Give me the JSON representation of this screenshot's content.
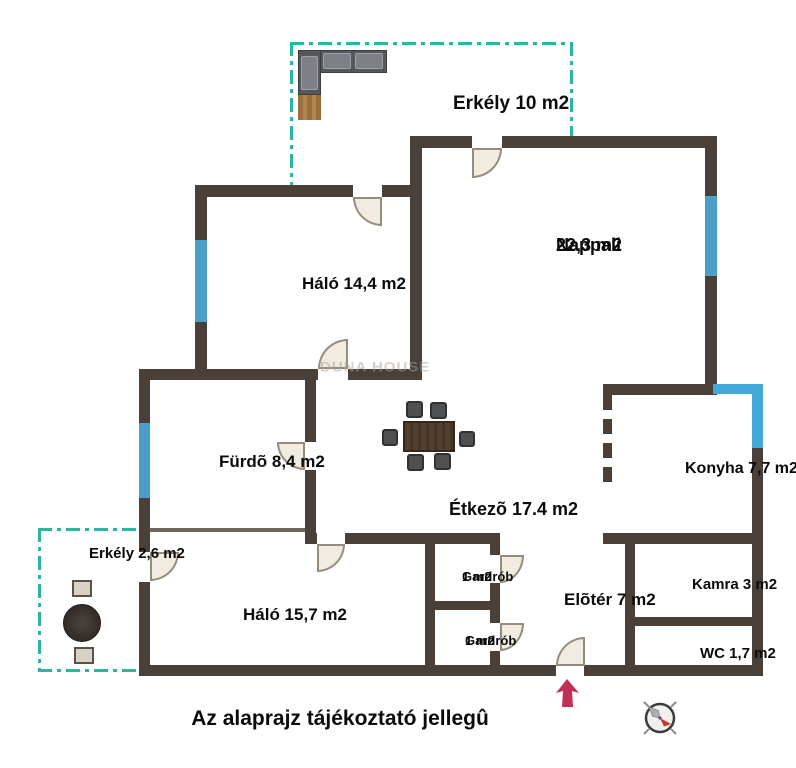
{
  "note": "Az alaprajz tájékoztató jellegû",
  "watermark": "DUNA HOUSE",
  "colors": {
    "wall": "#4a4038",
    "window_blue": "#4c9dc9",
    "corner_window_blue": "#42a8d8",
    "balcony_teal": "#2cb5a0",
    "door_fill": "#f2ebe0",
    "entrance_arrow": "#c23058",
    "compass_red": "#c0392b"
  },
  "rooms": [
    {
      "id": "erkely10",
      "lines": [
        "Erkély 10 m2"
      ],
      "cx": 453,
      "cy": 93,
      "fs": 19
    },
    {
      "id": "nappali",
      "lines": [
        "Nappali",
        "22,3 m2"
      ],
      "cx": 556,
      "cy": 235,
      "fs": 18
    },
    {
      "id": "halo14",
      "lines": [
        "Háló 14,4 m2"
      ],
      "cx": 302,
      "cy": 274,
      "fs": 17
    },
    {
      "id": "furdo",
      "lines": [
        "Fürdõ 8,4 m2"
      ],
      "cx": 219,
      "cy": 452,
      "fs": 17
    },
    {
      "id": "etkezo",
      "lines": [
        "Étkezõ 17.4 m2"
      ],
      "cx": 449,
      "cy": 499,
      "fs": 18
    },
    {
      "id": "konyha",
      "lines": [
        "Konyha 7,7 m2"
      ],
      "cx": 685,
      "cy": 460,
      "fs": 16
    },
    {
      "id": "erkely2",
      "lines": [
        "Erkély 2,6 m2"
      ],
      "cx": 89,
      "cy": 546,
      "fs": 15
    },
    {
      "id": "halo15",
      "lines": [
        "Háló 15,7 m2"
      ],
      "cx": 243,
      "cy": 605,
      "fs": 17
    },
    {
      "id": "gardrob-felso",
      "lines": [
        "Gardrób",
        "1 m2"
      ],
      "cx": 462,
      "cy": 570,
      "fs": 13
    },
    {
      "id": "eloter",
      "lines": [
        "Elõtér 7 m2"
      ],
      "cx": 564,
      "cy": 590,
      "fs": 17
    },
    {
      "id": "gardrob-also",
      "lines": [
        "Gardrób",
        "1 m2"
      ],
      "cx": 465,
      "cy": 634,
      "fs": 13
    },
    {
      "id": "kamra",
      "lines": [
        "Kamra 3 m2"
      ],
      "cx": 692,
      "cy": 577,
      "fs": 15
    },
    {
      "id": "wc",
      "lines": [
        "WC 1,7 m2"
      ],
      "cx": 700,
      "cy": 646,
      "fs": 15
    }
  ],
  "plan": {
    "walls": [
      {
        "x": 410,
        "y": 136,
        "w": 62,
        "h": 12
      },
      {
        "x": 502,
        "y": 136,
        "w": 215,
        "h": 12
      },
      {
        "x": 705,
        "y": 148,
        "w": 12,
        "h": 48
      },
      {
        "x": 705,
        "y": 276,
        "w": 12,
        "h": 119
      },
      {
        "x": 195,
        "y": 185,
        "w": 158,
        "h": 12
      },
      {
        "x": 382,
        "y": 185,
        "w": 40,
        "h": 12
      },
      {
        "x": 410,
        "y": 148,
        "w": 12,
        "h": 221
      },
      {
        "x": 195,
        "y": 197,
        "w": 12,
        "h": 43
      },
      {
        "x": 195,
        "y": 322,
        "w": 12,
        "h": 47
      },
      {
        "x": 139,
        "y": 369,
        "w": 179,
        "h": 11
      },
      {
        "x": 348,
        "y": 369,
        "w": 74,
        "h": 11
      },
      {
        "x": 139,
        "y": 380,
        "w": 11,
        "h": 43
      },
      {
        "x": 139,
        "y": 498,
        "w": 11,
        "h": 37
      },
      {
        "x": 305,
        "y": 380,
        "w": 11,
        "h": 62
      },
      {
        "x": 305,
        "y": 470,
        "w": 11,
        "h": 63
      },
      {
        "x": 305,
        "y": 533,
        "w": 12,
        "h": 11
      },
      {
        "x": 345,
        "y": 533,
        "w": 153,
        "h": 11
      },
      {
        "x": 425,
        "y": 533,
        "w": 10,
        "h": 143
      },
      {
        "x": 490,
        "y": 533,
        "w": 10,
        "h": 22
      },
      {
        "x": 490,
        "y": 583,
        "w": 10,
        "h": 40
      },
      {
        "x": 490,
        "y": 651,
        "w": 10,
        "h": 25
      },
      {
        "x": 425,
        "y": 601,
        "w": 75,
        "h": 9
      },
      {
        "x": 603,
        "y": 533,
        "w": 160,
        "h": 11
      },
      {
        "x": 625,
        "y": 533,
        "w": 10,
        "h": 143
      },
      {
        "x": 625,
        "y": 617,
        "w": 138,
        "h": 9
      },
      {
        "x": 752,
        "y": 448,
        "w": 11,
        "h": 228
      },
      {
        "x": 603,
        "y": 384,
        "w": 112,
        "h": 11
      },
      {
        "x": 139,
        "y": 665,
        "w": 417,
        "h": 11
      },
      {
        "x": 584,
        "y": 665,
        "w": 179,
        "h": 11
      },
      {
        "x": 139,
        "y": 535,
        "w": 11,
        "h": 17
      },
      {
        "x": 139,
        "y": 582,
        "w": 11,
        "h": 94
      }
    ],
    "thin_walls": [
      {
        "x": 150,
        "y": 528,
        "w": 155,
        "h": 4
      }
    ],
    "dashed_walls": [
      {
        "x": 603,
        "y": 395,
        "w": 9,
        "h": 92
      }
    ],
    "windows": [
      {
        "x": 195,
        "y": 240,
        "w": 12,
        "h": 82
      },
      {
        "x": 139,
        "y": 423,
        "w": 11,
        "h": 75
      },
      {
        "x": 705,
        "y": 196,
        "w": 12,
        "h": 80
      },
      {
        "x": 713,
        "y": 384,
        "w": 44,
        "h": 10,
        "bright": true
      },
      {
        "x": 752,
        "y": 384,
        "w": 11,
        "h": 64,
        "bright": true
      }
    ],
    "balcony_edges": [
      {
        "x": 290,
        "y": 42,
        "w": 283,
        "h": 3
      },
      {
        "x": 290,
        "y": 42,
        "w": 3,
        "h": 146
      },
      {
        "x": 570,
        "y": 42,
        "w": 3,
        "h": 98
      },
      {
        "x": 38,
        "y": 528,
        "w": 102,
        "h": 3
      },
      {
        "x": 38,
        "y": 528,
        "w": 3,
        "h": 144
      },
      {
        "x": 38,
        "y": 669,
        "w": 102,
        "h": 3
      }
    ],
    "doors": [
      {
        "id": "nappali-erkely",
        "x": 472,
        "y": 148,
        "w": 30,
        "h": 30,
        "corner": "br"
      },
      {
        "id": "halo14-erkely",
        "x": 353,
        "y": 197,
        "w": 29,
        "h": 29,
        "corner": "bl"
      },
      {
        "id": "halo14-etkezo",
        "x": 318,
        "y": 339,
        "w": 30,
        "h": 30,
        "corner": "tl"
      },
      {
        "id": "furdo",
        "x": 277,
        "y": 442,
        "w": 28,
        "h": 28,
        "corner": "bl"
      },
      {
        "id": "halo15-erkely",
        "x": 150,
        "y": 552,
        "w": 29,
        "h": 29,
        "corner": "br"
      },
      {
        "id": "etkezo-halo15",
        "x": 317,
        "y": 544,
        "w": 28,
        "h": 28,
        "corner": "br"
      },
      {
        "id": "gardrob-felso",
        "x": 500,
        "y": 555,
        "w": 24,
        "h": 28,
        "corner": "br"
      },
      {
        "id": "gardrob-also",
        "x": 500,
        "y": 623,
        "w": 24,
        "h": 28,
        "corner": "br"
      },
      {
        "id": "bejarat",
        "x": 556,
        "y": 637,
        "w": 29,
        "h": 29,
        "corner": "tl"
      }
    ],
    "furniture": [
      {
        "cls": "sofa",
        "x": 298,
        "y": 50,
        "w": 89,
        "h": 23
      },
      {
        "cls": "sofa",
        "x": 298,
        "y": 50,
        "w": 23,
        "h": 45
      },
      {
        "cls": "cushion",
        "x": 323,
        "y": 53,
        "w": 28,
        "h": 16
      },
      {
        "cls": "cushion",
        "x": 355,
        "y": 53,
        "w": 28,
        "h": 16
      },
      {
        "cls": "cushion",
        "x": 301,
        "y": 56,
        "w": 17,
        "h": 34
      },
      {
        "cls": "mat",
        "x": 298,
        "y": 95,
        "w": 23,
        "h": 25
      },
      {
        "cls": "rtable",
        "x": 63,
        "y": 604,
        "w": 38,
        "h": 38
      },
      {
        "cls": "tchair",
        "x": 72,
        "y": 580,
        "w": 20,
        "h": 17
      },
      {
        "cls": "tchair",
        "x": 74,
        "y": 647,
        "w": 20,
        "h": 17
      },
      {
        "cls": "dchair",
        "x": 406,
        "y": 401,
        "w": 17,
        "h": 17
      },
      {
        "cls": "dchair",
        "x": 430,
        "y": 402,
        "w": 17,
        "h": 17
      },
      {
        "cls": "dchair",
        "x": 382,
        "y": 429,
        "w": 16,
        "h": 17
      },
      {
        "cls": "dchair",
        "x": 459,
        "y": 431,
        "w": 16,
        "h": 16
      },
      {
        "cls": "dchair",
        "x": 407,
        "y": 454,
        "w": 17,
        "h": 17
      },
      {
        "cls": "dchair",
        "x": 434,
        "y": 453,
        "w": 17,
        "h": 17
      },
      {
        "cls": "dtable",
        "x": 403,
        "y": 421,
        "w": 52,
        "h": 31
      }
    ]
  }
}
